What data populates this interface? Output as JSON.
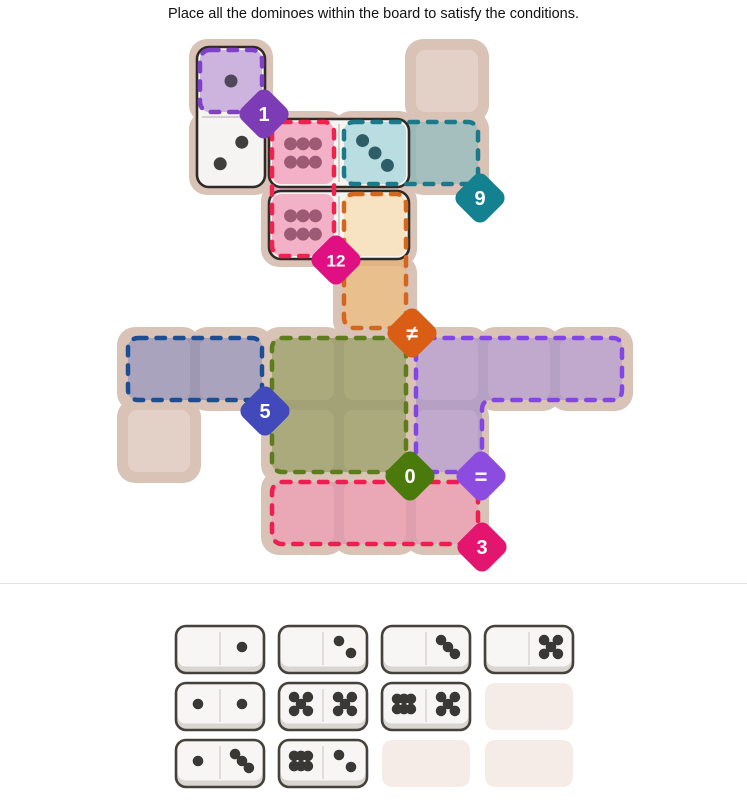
{
  "title": "Place all the dominoes within the board to satisfy the conditions.",
  "colors": {
    "board_bg": "#d9c2b6",
    "plain_cell": "#e3d1c8",
    "domino_fill": "#f7f5f2",
    "domino_border": "#2e2a25",
    "divider": "#e2e2e2",
    "tray_domino_bg": "#f7f6f4",
    "tray_domino_lip": "#d9d5d0",
    "tray_domino_border": "#45413c",
    "tray_half_divider": "#d8d5d1",
    "tray_pip": "#3a3835",
    "tray_empty_slot": "#f5ece7"
  },
  "grid": {
    "origin_x": 126,
    "origin_y": 48,
    "cell": 66,
    "pitch": 72
  },
  "board": {
    "cells": [
      {
        "c": 1,
        "r": 0,
        "fill": "#ccb4de",
        "pips": 1,
        "pip_color": "#50485a"
      },
      {
        "c": 4,
        "r": 0,
        "fill": "#e3d1c8"
      },
      {
        "c": 1,
        "r": 1,
        "fill": "#f6f4f2",
        "pips": 2,
        "pip_color": "#3f3e3d",
        "flip": true
      },
      {
        "c": 2,
        "r": 1,
        "fill": "#f3b1c7",
        "pips": 6,
        "pip_color": "#9c5a73"
      },
      {
        "c": 3,
        "r": 1,
        "fill": "#badde1",
        "pips": 3,
        "pip_color": "#2d5e67"
      },
      {
        "c": 4,
        "r": 1,
        "fill": "#a4bfbe"
      },
      {
        "c": 2,
        "r": 2,
        "fill": "#f3b1c7",
        "pips": 6,
        "pip_color": "#9c5a73"
      },
      {
        "c": 3,
        "r": 2,
        "fill": "#f7e3c2",
        "pips": 0
      },
      {
        "c": 3,
        "r": 3,
        "fill": "#e9bf8e"
      },
      {
        "c": 0,
        "r": 4,
        "fill": "#a9a3bd"
      },
      {
        "c": 1,
        "r": 4,
        "fill": "#a9a3bd"
      },
      {
        "c": 2,
        "r": 4,
        "fill": "#abaa7d"
      },
      {
        "c": 3,
        "r": 4,
        "fill": "#abaa7d"
      },
      {
        "c": 4,
        "r": 4,
        "fill": "#c0a9cc"
      },
      {
        "c": 5,
        "r": 4,
        "fill": "#c0a9cc"
      },
      {
        "c": 6,
        "r": 4,
        "fill": "#c0a9cc"
      },
      {
        "c": 0,
        "r": 5,
        "fill": "#e3d1c8"
      },
      {
        "c": 2,
        "r": 5,
        "fill": "#abaa7d"
      },
      {
        "c": 3,
        "r": 5,
        "fill": "#abaa7d"
      },
      {
        "c": 4,
        "r": 5,
        "fill": "#c0a9cc"
      },
      {
        "c": 2,
        "r": 6,
        "fill": "#eaa8b6"
      },
      {
        "c": 3,
        "r": 6,
        "fill": "#eaa8b6"
      },
      {
        "c": 4,
        "r": 6,
        "fill": "#eaa8b6"
      }
    ],
    "regions": [
      {
        "id": "purple-1",
        "cells": [
          [
            1,
            0
          ]
        ],
        "sep": "#c3a8d3",
        "dash": "#8040c8",
        "badge": {
          "label": "1",
          "color": "#7d3bb6",
          "x": 264,
          "y": 114,
          "font": 20
        }
      },
      {
        "id": "pink-12",
        "cells": [
          [
            2,
            1
          ],
          [
            2,
            2
          ]
        ],
        "sep": "#e9a2bd",
        "dash": "#f2224f",
        "badge": {
          "label": "12",
          "color": "#e00f82",
          "x": 336,
          "y": 260,
          "font": 17
        }
      },
      {
        "id": "teal-9",
        "cells": [
          [
            3,
            1
          ],
          [
            4,
            1
          ]
        ],
        "sep": "#9cb8b7",
        "dash": "#1b7a89",
        "badge": {
          "label": "9",
          "color": "#13818f",
          "x": 480,
          "y": 198,
          "font": 20
        }
      },
      {
        "id": "orange-neq",
        "cells": [
          [
            3,
            2
          ],
          [
            3,
            3
          ]
        ],
        "sep": "#e2b587",
        "dash": "#d4671e",
        "badge": {
          "label": "≠",
          "color": "#d95d15",
          "x": 412,
          "y": 333,
          "font": 21
        }
      },
      {
        "id": "blue-5",
        "cells": [
          [
            0,
            4
          ],
          [
            1,
            4
          ]
        ],
        "sep": "#9e98b2",
        "dash": "#1d4d92",
        "badge": {
          "label": "5",
          "color": "#4149bb",
          "x": 265,
          "y": 411,
          "font": 20
        }
      },
      {
        "id": "green-0",
        "cells": [
          [
            2,
            4
          ],
          [
            3,
            4
          ],
          [
            2,
            5
          ],
          [
            3,
            5
          ]
        ],
        "sep": "#a3a276",
        "dash": "#5d7d1c",
        "badge": {
          "label": "0",
          "color": "#4a7a0c",
          "x": 410,
          "y": 476,
          "font": 20
        }
      },
      {
        "id": "purple-eq",
        "cells": [
          [
            4,
            4
          ],
          [
            5,
            4
          ],
          [
            6,
            4
          ],
          [
            4,
            5
          ]
        ],
        "sep": "#b6a0c4",
        "dash": "#8345e4",
        "outline_d": "M 426 338 L 612 338 Q 622 338 622 348 L 622 390 Q 622 400 612 400 L 492 400 Q 482 400 482 410 L 482 462 Q 482 472 472 472 L 426 472 Q 416 472 416 462 L 416 348 Q 416 338 426 338 Z",
        "badge": {
          "label": "=",
          "color": "#8c4cdf",
          "x": 481,
          "y": 476,
          "font": 22
        }
      },
      {
        "id": "pink-3",
        "cells": [
          [
            2,
            6
          ],
          [
            3,
            6
          ],
          [
            4,
            6
          ]
        ],
        "sep": "#e09fae",
        "dash": "#ef1d51",
        "badge": {
          "label": "3",
          "color": "#e4156f",
          "x": 482,
          "y": 547,
          "font": 20
        }
      }
    ],
    "dominoes_placed": [
      {
        "cells": [
          [
            1,
            0
          ],
          [
            1,
            1
          ]
        ],
        "pips": [
          1,
          2
        ]
      },
      {
        "cells": [
          [
            2,
            1
          ],
          [
            3,
            1
          ]
        ],
        "pips": [
          6,
          3
        ]
      },
      {
        "cells": [
          [
            2,
            2
          ],
          [
            3,
            2
          ]
        ],
        "pips": [
          6,
          0
        ]
      }
    ]
  },
  "tray": {
    "slots": [
      {
        "pips": [
          0,
          1
        ]
      },
      {
        "pips": [
          0,
          2
        ]
      },
      {
        "pips": [
          0,
          3
        ]
      },
      {
        "pips": [
          0,
          5
        ]
      },
      {
        "pips": [
          1,
          1
        ]
      },
      {
        "pips": [
          5,
          5
        ]
      },
      {
        "pips": [
          6,
          5
        ]
      },
      {
        "empty": true
      },
      {
        "pips": [
          1,
          3
        ]
      },
      {
        "pips": [
          6,
          2
        ]
      },
      {
        "empty": true
      },
      {
        "empty": true
      }
    ],
    "cols": 4,
    "slot_w": 88,
    "slot_h": 47,
    "start_x": 176,
    "pitch_x": 103,
    "row_ys": [
      8,
      65,
      122
    ]
  }
}
